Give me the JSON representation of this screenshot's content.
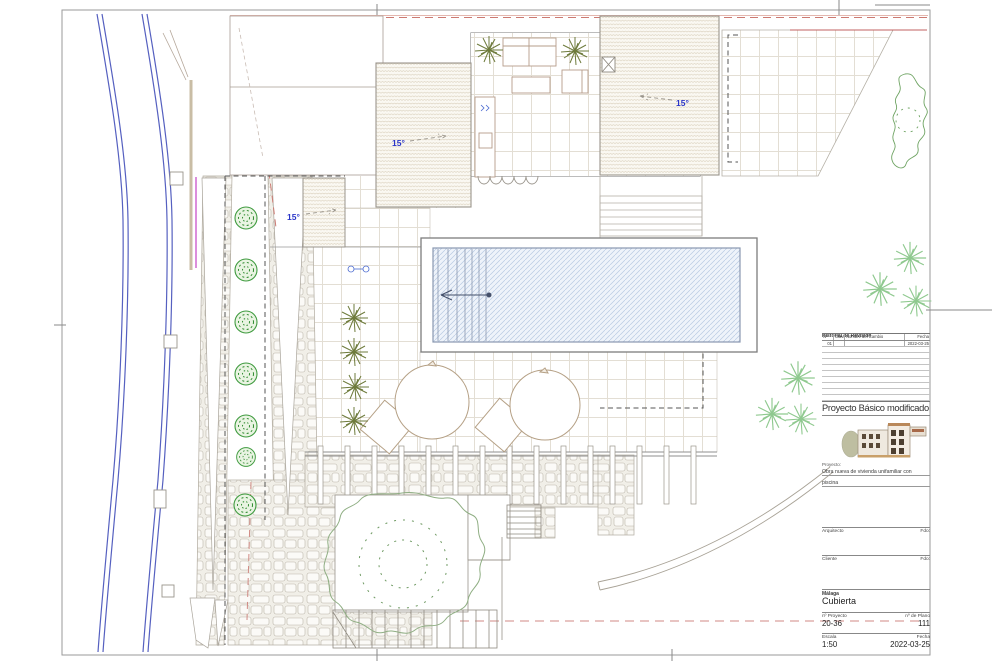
{
  "plan": {
    "slope_labels": [
      "15°",
      "15°",
      "15°"
    ],
    "colors": {
      "road_blue": "#5560c0",
      "boundary_red": "#cc7a72",
      "slope_label_blue": "#2a35c8",
      "vegetation_green": "#3f9b3f",
      "pool_hatch_blue": "#b9c9e2",
      "magenta_line": "#cc5ecc",
      "roof_hatch_tan": "#d6cbb6"
    }
  },
  "title_block": {
    "revision": {
      "title": "Historial de Revisión",
      "columns": [
        "Nº",
        "Clave",
        "Nombre del Cambio",
        "Fecha"
      ],
      "rows": [
        [
          "01",
          "",
          "",
          "2022-03-25"
        ]
      ]
    },
    "status": "Proyecto Básico modificado",
    "project_label": "Proyecto:",
    "project_desc_line1": "Obra nueva de vivienda unifamiliar con",
    "project_desc_line2": "piscina",
    "architect_label": "Arquitecto",
    "architect_sign": "Fdo:",
    "client_label": "Cliente",
    "client_sign": "Fdo:",
    "location": "Málaga",
    "sheet_name": "Cubierta",
    "project_no_label": "nº Proyecto",
    "project_no": "20-36",
    "plan_no_label": "nº de Plano",
    "plan_no": "111",
    "scale_label": "Escala",
    "scale": "1:50",
    "date_label": "Fecha",
    "date": "2022-03-25"
  }
}
